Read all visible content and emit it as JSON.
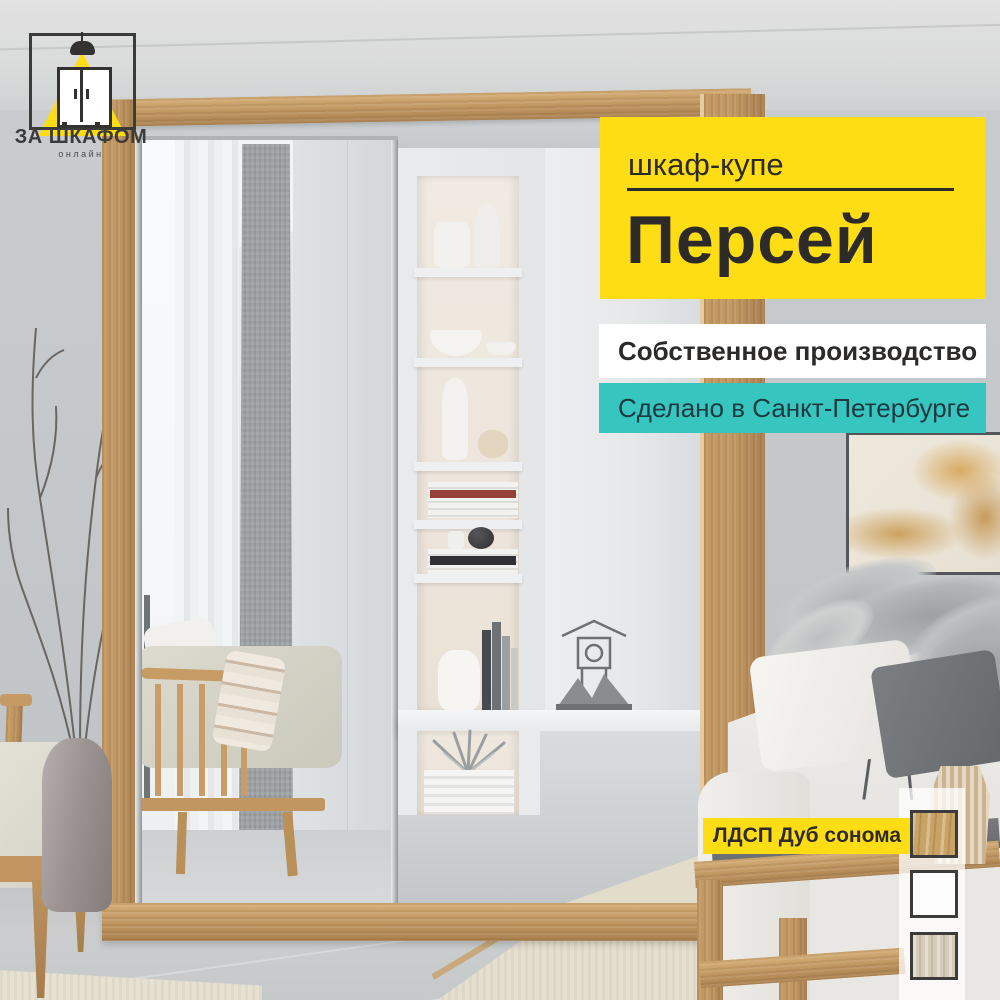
{
  "overlay": {
    "logo": {
      "brand": "ЗА ШКАФОМ",
      "tagline": "онлайн",
      "icons": [
        "pendant-lamp-icon",
        "light-beam-icon",
        "wardrobe-icon"
      ]
    },
    "product_banner": {
      "category": "шкаф-купе",
      "name": "Персей"
    },
    "production_badge": {
      "label": "Собственное производство"
    },
    "origin_badge": {
      "label": "Сделано в Санкт-Петербурге"
    },
    "material_badge": {
      "label": "ЛДСП Дуб сонома",
      "swatches": [
        {
          "name": "oak-sonoma-swatch",
          "color": "#C9A266"
        },
        {
          "name": "white-swatch",
          "color": "#FDFDFD"
        },
        {
          "name": "elm-light-swatch",
          "color": "#D4CCB9"
        }
      ]
    }
  },
  "colors": {
    "accent_yellow": "#FFDD15",
    "accent_teal": "#36C5BF",
    "text_dark": "#2C2B2A",
    "text_on_teal": "#1E3940",
    "swatch_border": "#3C3C3B"
  }
}
